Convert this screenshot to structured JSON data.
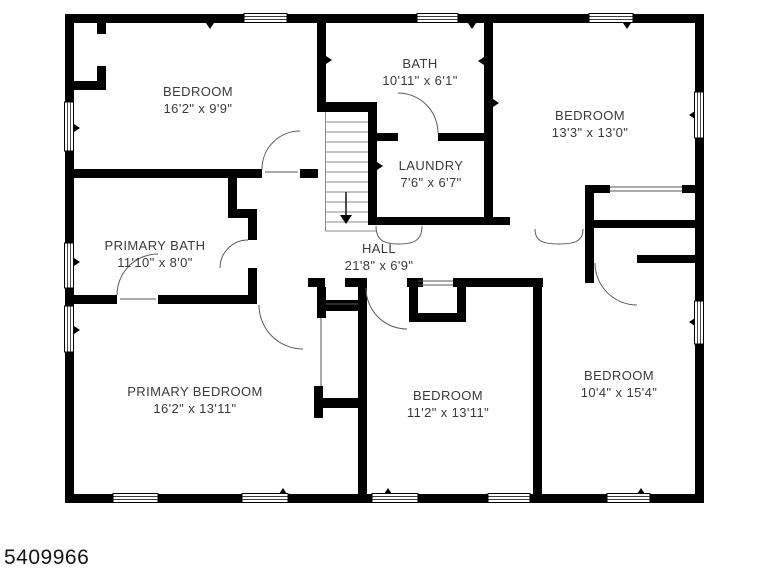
{
  "colors": {
    "wall": "#000000",
    "text": "#3a3a3a",
    "background": "#ffffff"
  },
  "listing_id": "5409966",
  "rooms": [
    {
      "id": "bedroom-top-left",
      "name": "BEDROOM",
      "dims": "16'2\" x 9'9\""
    },
    {
      "id": "bath",
      "name": "BATH",
      "dims": "10'11\" x 6'1\""
    },
    {
      "id": "bedroom-top-right",
      "name": "BEDROOM",
      "dims": "13'3\" x 13'0\""
    },
    {
      "id": "laundry",
      "name": "LAUNDRY",
      "dims": "7'6\" x 6'7\""
    },
    {
      "id": "primary-bath",
      "name": "PRIMARY BATH",
      "dims": "11'10\" x 8'0\""
    },
    {
      "id": "hall",
      "name": "HALL",
      "dims": "21'8\" x 6'9\""
    },
    {
      "id": "primary-bedroom",
      "name": "PRIMARY BEDROOM",
      "dims": "16'2\" x 13'11\""
    },
    {
      "id": "bedroom-bottom-mid",
      "name": "BEDROOM",
      "dims": "11'2\" x 13'11\""
    },
    {
      "id": "bedroom-bottom-right",
      "name": "BEDROOM",
      "dims": "10'4\" x 15'4\""
    }
  ]
}
